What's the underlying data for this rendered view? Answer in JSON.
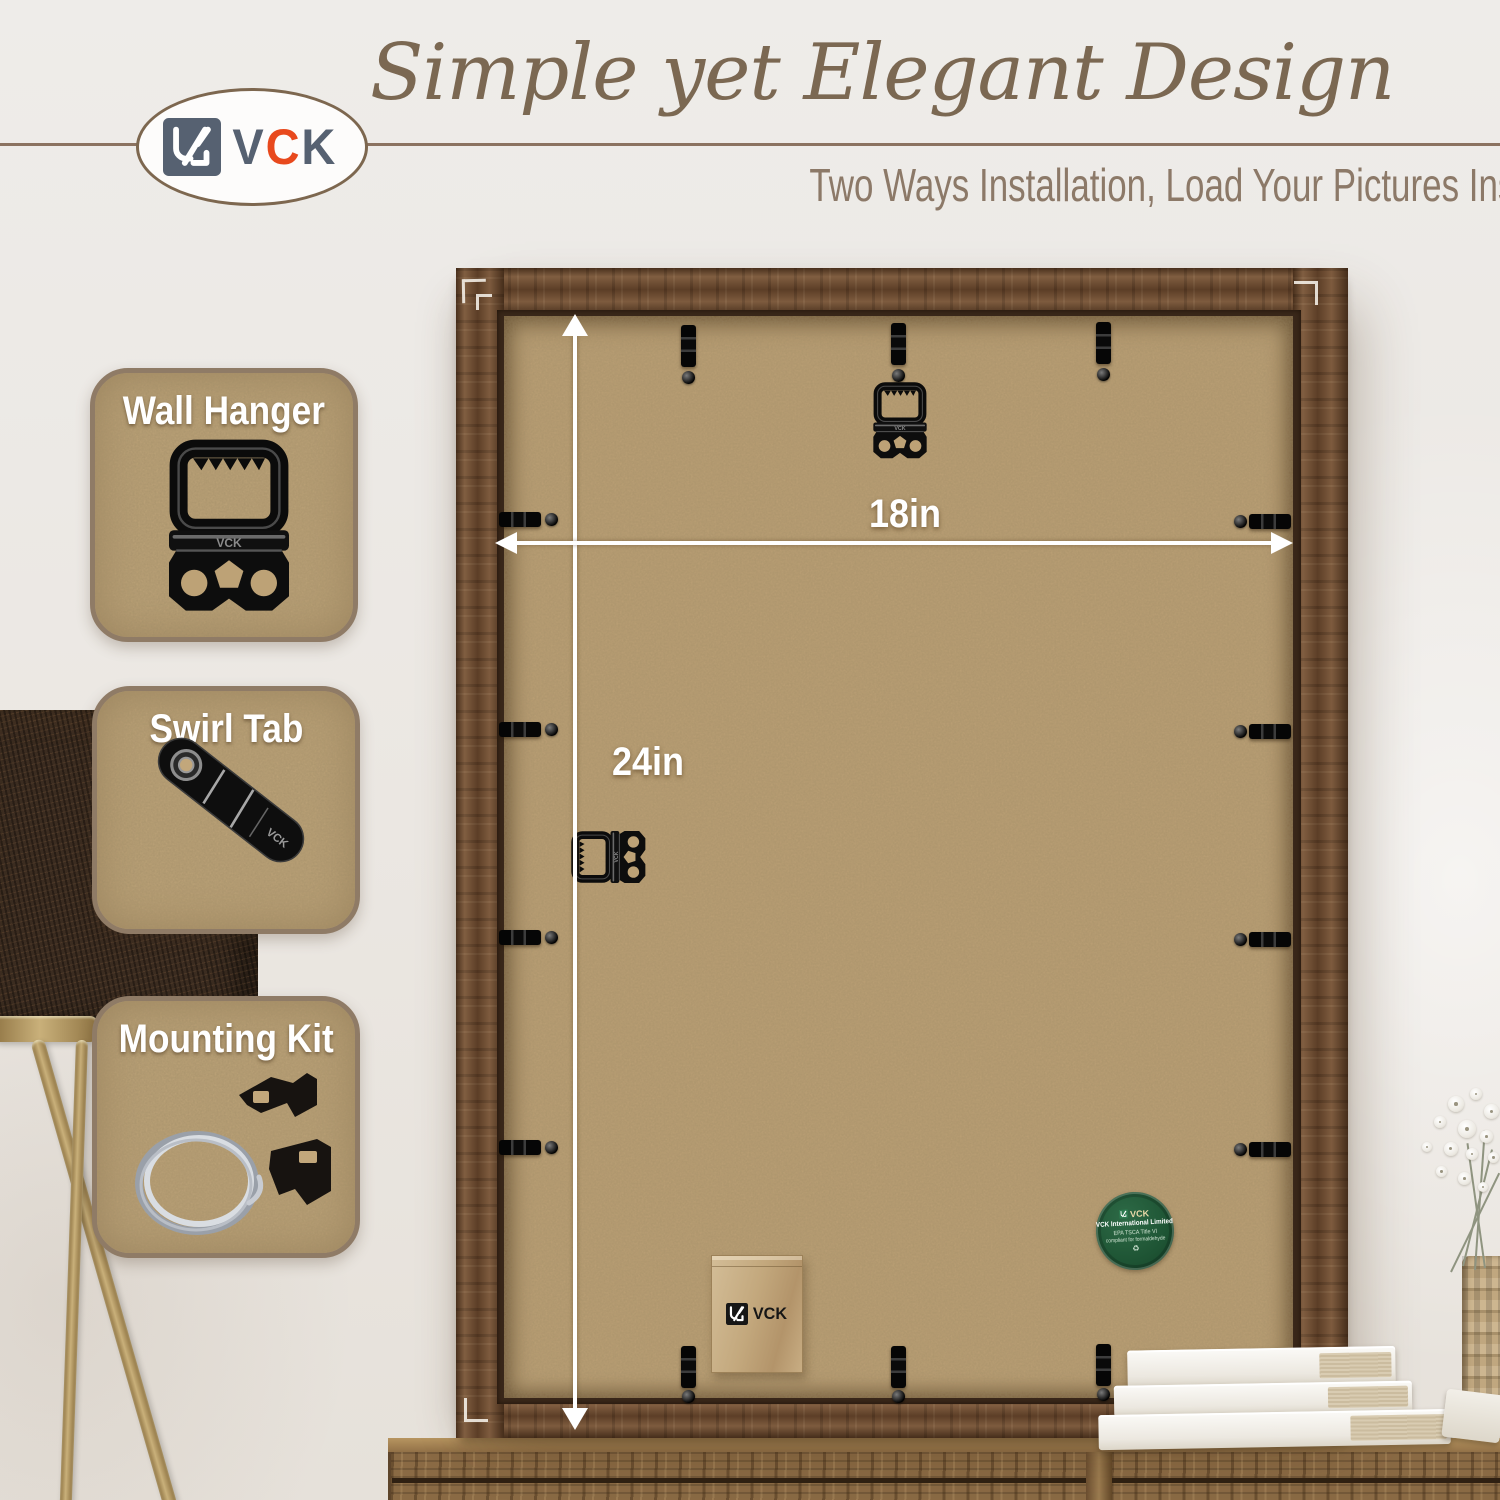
{
  "brand": {
    "name": "VCK",
    "logo": {
      "letters": [
        "V",
        "C",
        "K"
      ],
      "accent_letter": "C",
      "letter_color": "#566171",
      "accent_color": "#e8491d",
      "mark_icon": "vck-monogram-icon"
    }
  },
  "header": {
    "title": "Simple yet Elegant Design",
    "subtitle": "Two Ways Installation, Load Your Pictures Instantly"
  },
  "feature_cards": [
    {
      "label": "Wall Hanger",
      "icon": "wall-hanger-photo"
    },
    {
      "label": "Swirl Tab",
      "icon": "swirl-tab-photo"
    },
    {
      "label": "Mounting Kit",
      "icon": "mounting-kit-photo"
    }
  ],
  "frame_annotations": {
    "width_label": "18in",
    "height_label": "24in"
  },
  "compliance_sticker": {
    "brand": "VCK",
    "company": "VCK International Limited",
    "cert_line1": "EPA TSCA Title VI",
    "cert_line2": "compliant for formaldehyde",
    "leaf_icon": "recycle-leaf-icon"
  },
  "hardware_bag": {
    "brand": "VCK"
  },
  "colors": {
    "title_text": "#7b6852",
    "subtitle_text": "#8c7968",
    "divider": "#8b7260",
    "card_background": "#c2a77b",
    "card_border": "#8f7b66",
    "frame_wood": "#6f4c31",
    "mdf_back": "#c0a377",
    "sticker_green": "#1e5434",
    "accent_orange": "#e8491d",
    "annotation_white": "#ffffff",
    "cabinet_wood": "#8a6a44"
  }
}
